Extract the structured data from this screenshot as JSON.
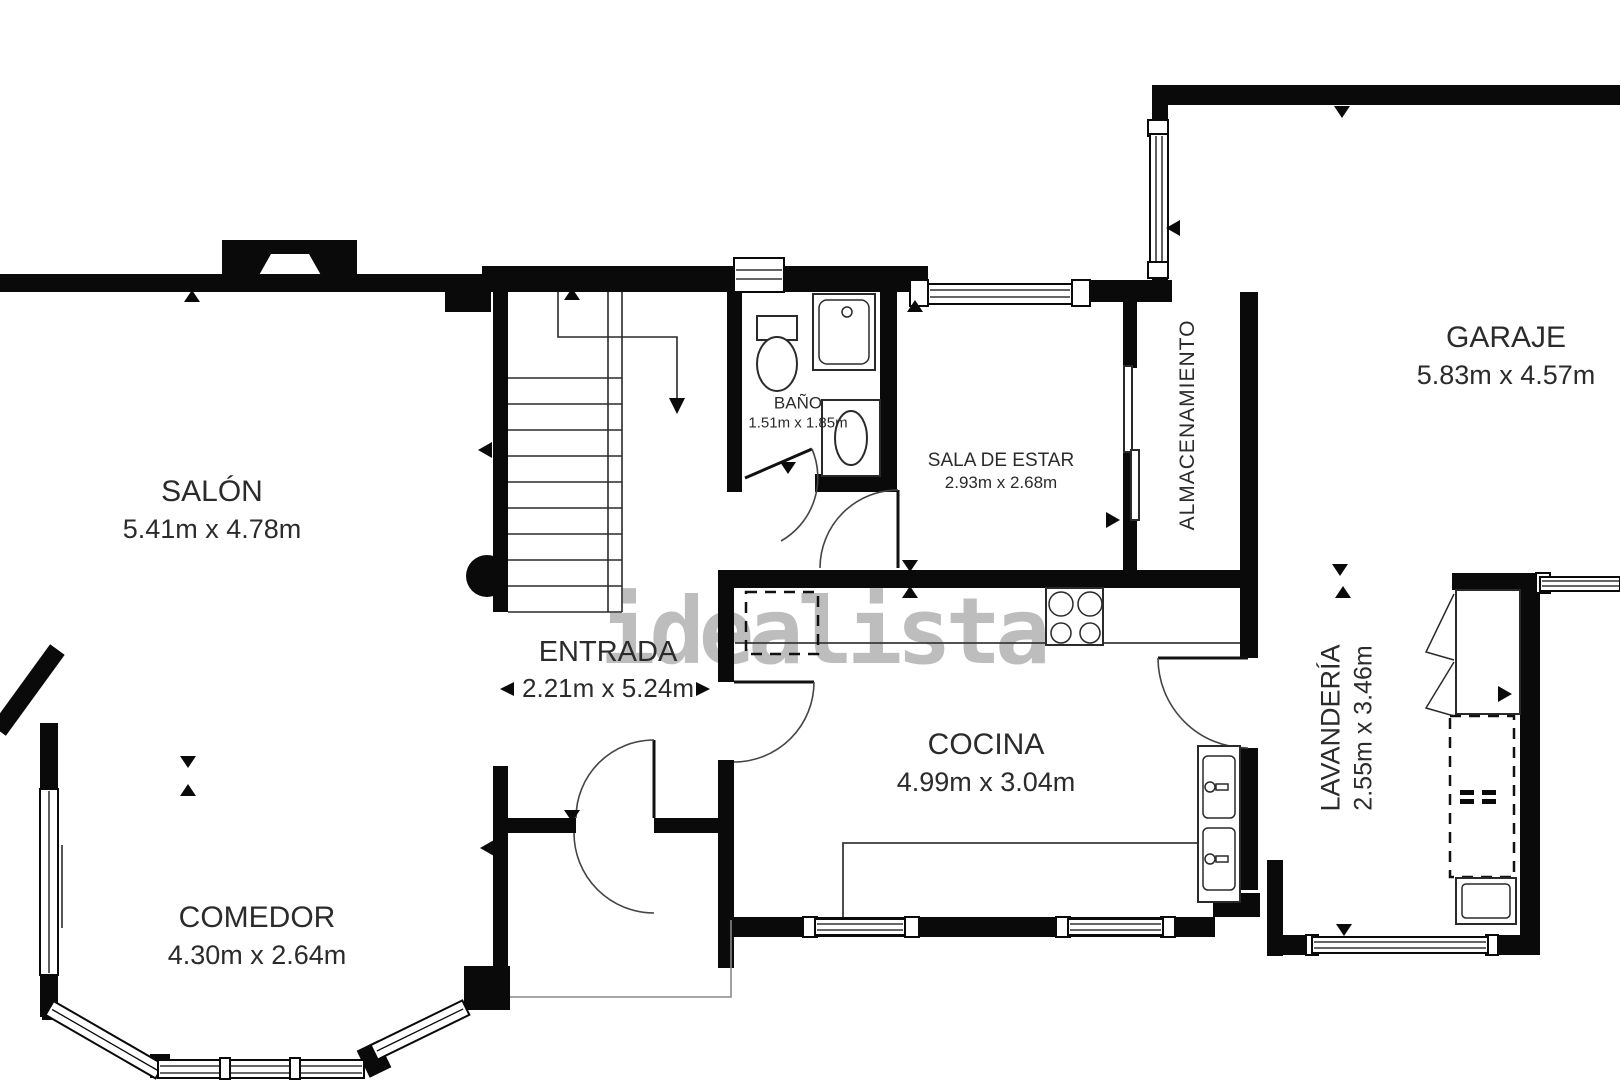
{
  "plan": {
    "watermark": "idealista",
    "rooms": {
      "salon": {
        "name": "SALÓN",
        "dims": "5.41m x 4.78m"
      },
      "comedor": {
        "name": "COMEDOR",
        "dims": "4.30m x 2.64m"
      },
      "entrada": {
        "name": "ENTRADA",
        "dims": "2.21m x 5.24m"
      },
      "bano": {
        "name": "BAÑO",
        "dims": "1.51m x 1.85m"
      },
      "sala_de_estar": {
        "name": "SALA DE ESTAR",
        "dims": "2.93m x 2.68m"
      },
      "almacenamiento": {
        "name": "ALMACENAMIENTO"
      },
      "cocina": {
        "name": "COCINA",
        "dims": "4.99m x 3.04m"
      },
      "garaje": {
        "name": "GARAJE",
        "dims": "5.83m x 4.57m"
      },
      "lavanderia": {
        "name": "LAVANDERÍA",
        "dims": "2.55m x 3.46m"
      }
    },
    "colors": {
      "wall": "#0a0a0a",
      "text": "#2b2b2b",
      "watermark": "#bdbdbd",
      "background": "#ffffff"
    }
  }
}
